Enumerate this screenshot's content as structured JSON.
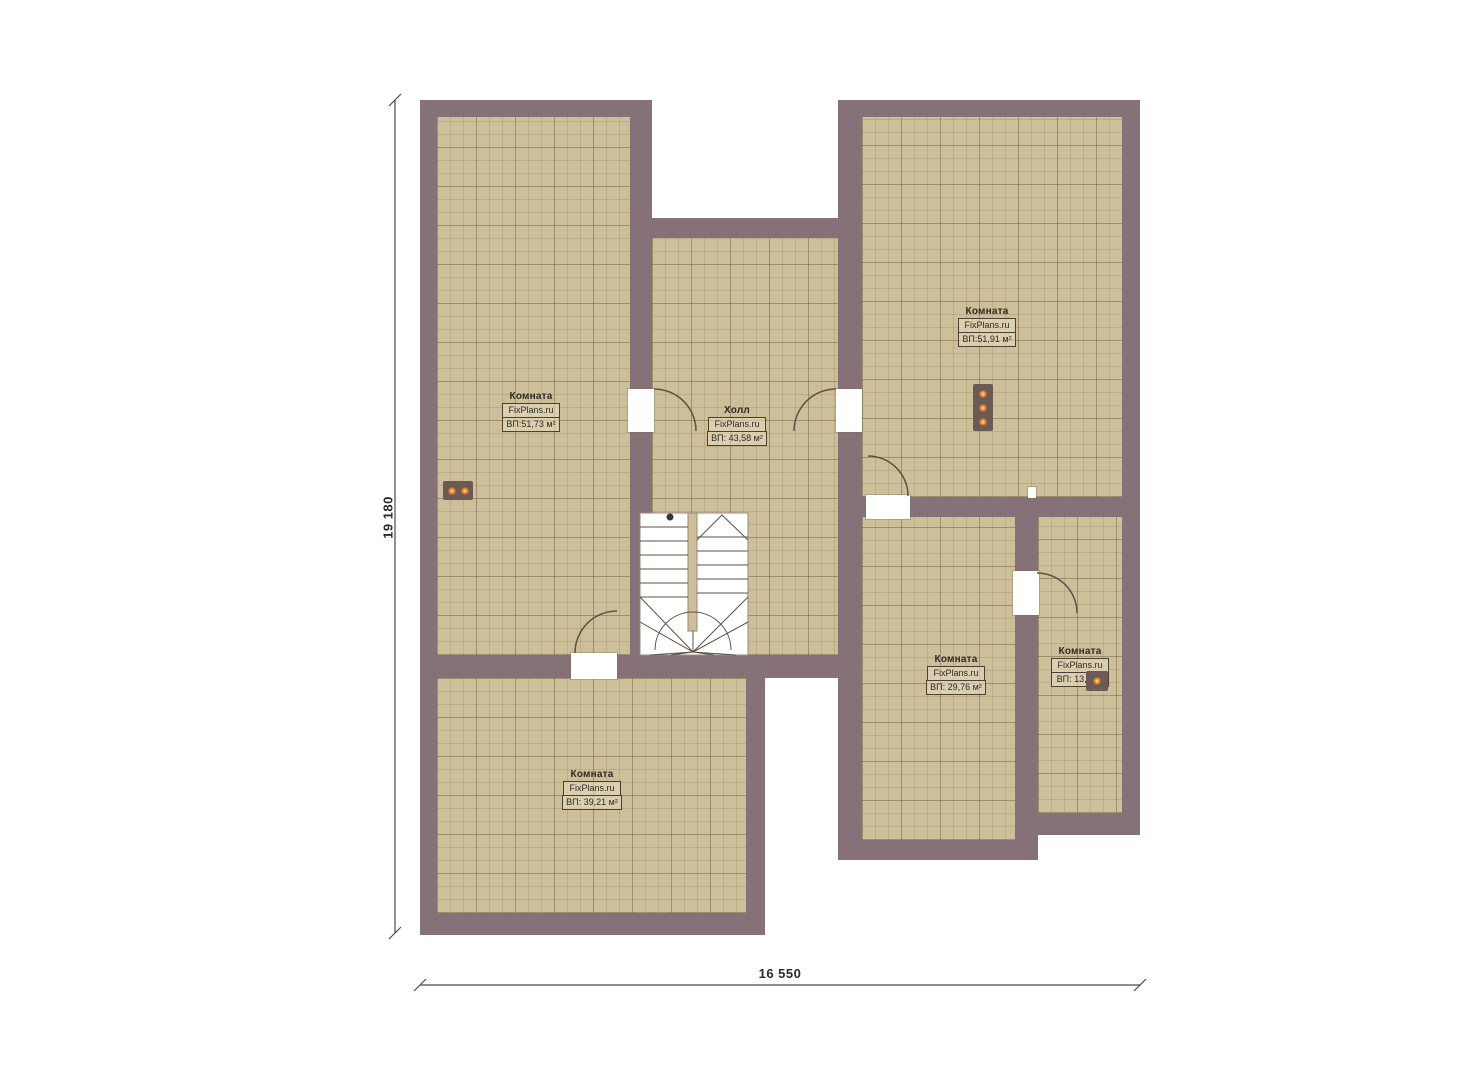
{
  "plan": {
    "title": "Floor plan",
    "dim_height": "19 180",
    "dim_width": "16 550",
    "rooms": [
      {
        "id": "left-room",
        "name": "Комната",
        "brand": "FixPlans.ru",
        "area": "ВП:51,73 м²"
      },
      {
        "id": "hall",
        "name": "Холл",
        "brand": "FixPlans.ru",
        "area": "ВП: 43,58 м²"
      },
      {
        "id": "top-right-room",
        "name": "Комната",
        "brand": "FixPlans.ru",
        "area": "ВП:51,91 м²"
      },
      {
        "id": "bottom-middle-room",
        "name": "Комната",
        "brand": "FixPlans.ru",
        "area": "ВП: 29,76 м²"
      },
      {
        "id": "right-small-room",
        "name": "Комната",
        "brand": "FixPlans.ru",
        "area": "ВП: 13,4 м²"
      },
      {
        "id": "bottom-left-room",
        "name": "Комната",
        "brand": "FixPlans.ru",
        "area": "ВП: 39,21 м²"
      }
    ],
    "colors": {
      "wall": "#877179",
      "floor": "#cdbf99",
      "device_dot": "#f08a28"
    }
  }
}
